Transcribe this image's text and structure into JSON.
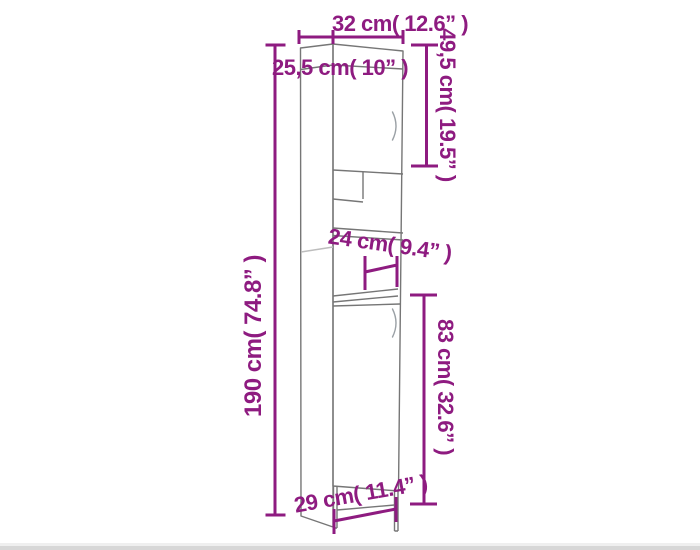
{
  "colors": {
    "accent": "#8e1b80",
    "cabinet_line": "#767676"
  },
  "diagram": {
    "kind": "furniture-dimension-drawing",
    "subject": "tall-cabinet-with-two-doors-and-open-shelves"
  },
  "dimensions": {
    "top_width": {
      "label": "32 cm( 12.6” )",
      "cm": "32",
      "inches": "12.6"
    },
    "top_depth": {
      "label": "25,5 cm( 10” )",
      "cm": "25,5",
      "inches": "10"
    },
    "upper_door_height": {
      "label": "49,5 cm( 19.5” )",
      "cm": "49,5",
      "inches": "19.5"
    },
    "total_height": {
      "label": "190 cm( 74.8” )",
      "cm": "190",
      "inches": "74.8"
    },
    "lower_door_height": {
      "label": "83 cm( 32.6” )",
      "cm": "83",
      "inches": "32.6"
    },
    "inner_shelf_depth": {
      "label": "24 cm( 9.4” )",
      "cm": "24",
      "inches": "9.4"
    },
    "base_width": {
      "label": "29 cm( 11.4” )",
      "cm": "29",
      "inches": "11.4"
    }
  }
}
